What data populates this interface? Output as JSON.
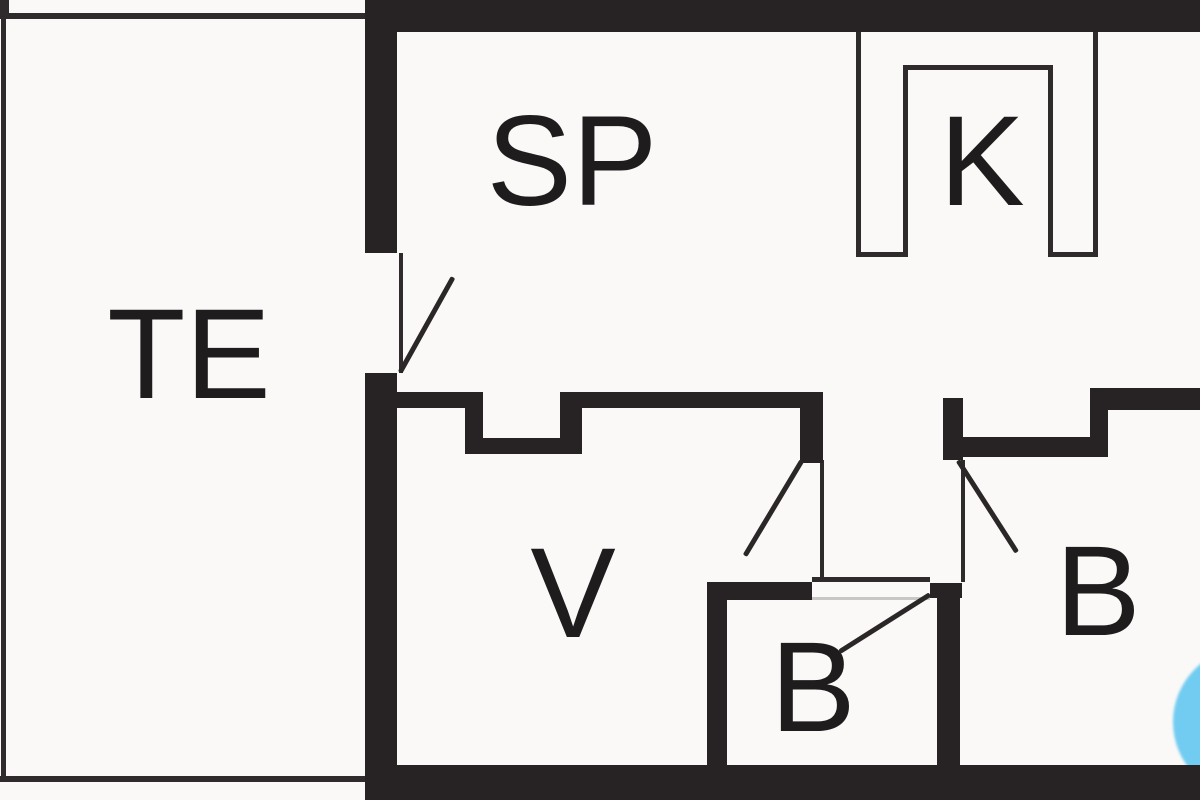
{
  "title": "Summerhouse floor plan",
  "rooms": [
    {
      "key": "te",
      "label": "TE"
    },
    {
      "key": "sp",
      "label": "SP"
    },
    {
      "key": "k",
      "label": "K"
    },
    {
      "key": "v",
      "label": "V"
    },
    {
      "key": "b_small",
      "label": "B"
    },
    {
      "key": "b_right",
      "label": "B"
    }
  ],
  "colors": {
    "wall": "#272324",
    "thin_line": "#2f2b2c",
    "background": "#faf9f7",
    "fixture_blue": "#72ccf1"
  }
}
